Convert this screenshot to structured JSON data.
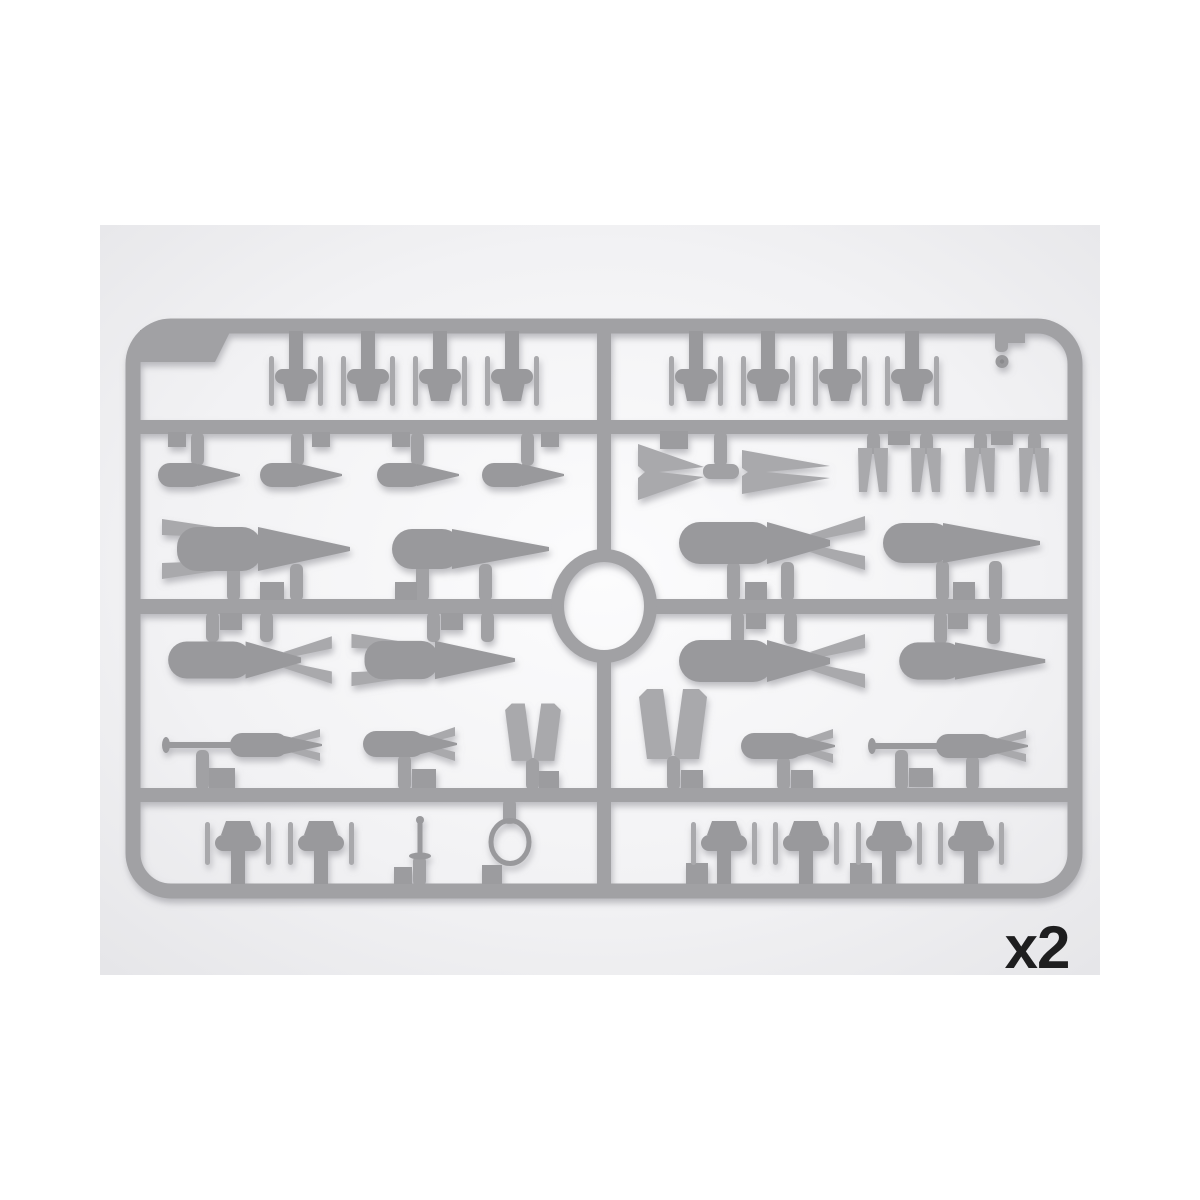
{
  "scene": {
    "description": "Product photo of a gray injection-molded plastic model-kit sprue (parts frame) containing aircraft bombs, drop tanks, tail fins and armament parts, shown on a light studio background",
    "quantity_label": "x2"
  },
  "colors": {
    "page_bg": "#ffffff",
    "photo_edge": "#e4e4e7",
    "photo_mid": "#f2f2f4",
    "photo_center": "#fcfcfd",
    "sprue": "#a1a1a4",
    "sprue_dark": "#8a8a8d",
    "part": "#99999c",
    "part_light": "#a9a9ac",
    "gate": "#9c9c9f",
    "label": "#1e1e1f",
    "shadow": "#8b8b92"
  },
  "sprue": {
    "layout": "rounded-rectangle frame, three horizontal runners, one central vertical runner, central ring",
    "parts_inventory": [
      {
        "part": "finned-stub-small",
        "count": 8,
        "location": "top row"
      },
      {
        "part": "slim-drop-tank",
        "count": 4,
        "location": "upper left"
      },
      {
        "part": "chevron-tail-cone",
        "count": 2,
        "location": "upper right"
      },
      {
        "part": "fork-tail-fin",
        "count": 4,
        "location": "upper right"
      },
      {
        "part": "large-bomb-finned",
        "count": 4,
        "location": "middle rows"
      },
      {
        "part": "large-bomb-teardrop",
        "count": 4,
        "location": "middle rows"
      },
      {
        "part": "rod-nose-bomb",
        "count": 2,
        "location": "lower middle"
      },
      {
        "part": "small-finned-bomb",
        "count": 2,
        "location": "lower middle"
      },
      {
        "part": "v-tail-fin",
        "count": 2,
        "location": "lower middle"
      },
      {
        "part": "finned-stub-large",
        "count": 6,
        "location": "bottom row"
      },
      {
        "part": "fuze-pin",
        "count": 1,
        "location": "bottom left"
      },
      {
        "part": "ring",
        "count": 1,
        "location": "bottom left"
      },
      {
        "part": "small-disc",
        "count": 1,
        "location": "top right"
      }
    ]
  }
}
